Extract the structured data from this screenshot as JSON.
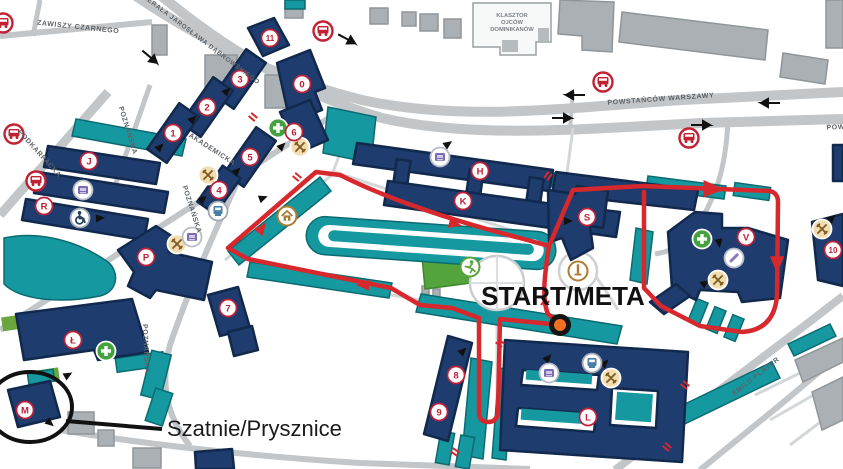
{
  "map": {
    "labels": {
      "start_meta": "START/META",
      "changing_rooms": "Szatnie/Prysznice",
      "klasztor": [
        "KLASZTOR",
        "OJCÓW",
        "DOMINIKANÓW"
      ]
    },
    "colors": {
      "navy": "#1e3c6d",
      "navy_dark": "#12294e",
      "teal": "#15989f",
      "teal_dark": "#0b6b70",
      "route_red": "#d7282d",
      "badge_red": "#c02138",
      "road_gray": "#c2c6c9",
      "building_gray": "#aab0b4",
      "field_green": "#55a33c",
      "start_orange": "#f36f21"
    },
    "streets": [
      {
        "name": "ZAWISZY CZARNEGO",
        "x": 78,
        "y": 29,
        "rot": 6,
        "size": 7
      },
      {
        "name": "GENERAŁA JAROSŁAWA DĄBROWSKIEGO",
        "x": 196,
        "y": 38,
        "rot": 37,
        "size": 6.5
      },
      {
        "name": "PODKARPACKA",
        "x": 38,
        "y": 155,
        "rot": 48,
        "size": 7
      },
      {
        "name": "POZNAŃSKA",
        "x": 126,
        "y": 131,
        "rot": 73,
        "size": 7
      },
      {
        "name": "AKADEMICKA",
        "x": 211,
        "y": 151,
        "rot": 33,
        "size": 7
      },
      {
        "name": "POZNAŃSKA",
        "x": 190,
        "y": 210,
        "rot": 72,
        "size": 7
      },
      {
        "name": "POZNAŃSKA",
        "x": 144,
        "y": 349,
        "rot": 87,
        "size": 7
      },
      {
        "name": "POWSTAŃCÓW WARSZAWY",
        "x": 661,
        "y": 101,
        "rot": -4,
        "size": 7
      },
      {
        "name": "POWSTAŃCÓW WARSZAWY",
        "x": 880,
        "y": 127,
        "rot": -3,
        "size": 7
      },
      {
        "name": "EMILII PLATER",
        "x": 757,
        "y": 378,
        "rot": -38,
        "size": 7
      }
    ],
    "badges": [
      {
        "label": "0",
        "x": 302,
        "y": 84
      },
      {
        "label": "1",
        "x": 173,
        "y": 133
      },
      {
        "label": "2",
        "x": 207,
        "y": 107
      },
      {
        "label": "3",
        "x": 240,
        "y": 79
      },
      {
        "label": "4",
        "x": 219,
        "y": 190
      },
      {
        "label": "5",
        "x": 250,
        "y": 157
      },
      {
        "label": "6",
        "x": 294,
        "y": 132
      },
      {
        "label": "7",
        "x": 228,
        "y": 308
      },
      {
        "label": "8",
        "x": 456,
        "y": 375
      },
      {
        "label": "9",
        "x": 439,
        "y": 412
      },
      {
        "label": "10",
        "x": 833,
        "y": 250
      },
      {
        "label": "11",
        "x": 270,
        "y": 38
      },
      {
        "label": "H",
        "x": 480,
        "y": 171
      },
      {
        "label": "J",
        "x": 89,
        "y": 161
      },
      {
        "label": "K",
        "x": 463,
        "y": 201
      },
      {
        "label": "L",
        "x": 588,
        "y": 417
      },
      {
        "label": "Ł",
        "x": 73,
        "y": 340
      },
      {
        "label": "M",
        "x": 25,
        "y": 410
      },
      {
        "label": "P",
        "x": 146,
        "y": 257
      },
      {
        "label": "R",
        "x": 44,
        "y": 206
      },
      {
        "label": "S",
        "x": 587,
        "y": 217
      },
      {
        "label": "V",
        "x": 746,
        "y": 237
      }
    ],
    "icons": [
      {
        "type": "bus-stop",
        "x": 3,
        "y": 23
      },
      {
        "type": "bus-stop",
        "x": 14,
        "y": 134
      },
      {
        "type": "bus-stop",
        "x": 36,
        "y": 181
      },
      {
        "type": "bus-stop",
        "x": 323,
        "y": 31
      },
      {
        "type": "bus-stop",
        "x": 603,
        "y": 82
      },
      {
        "type": "bus-stop",
        "x": 689,
        "y": 138
      },
      {
        "type": "restaurant",
        "x": 300,
        "y": 147
      },
      {
        "type": "restaurant",
        "x": 208,
        "y": 175
      },
      {
        "type": "restaurant",
        "x": 177,
        "y": 244
      },
      {
        "type": "restaurant",
        "x": 718,
        "y": 280
      },
      {
        "type": "restaurant",
        "x": 822,
        "y": 229
      },
      {
        "type": "restaurant",
        "x": 611,
        "y": 378
      },
      {
        "type": "medical",
        "x": 278,
        "y": 128
      },
      {
        "type": "medical",
        "x": 106,
        "y": 351
      },
      {
        "type": "medical",
        "x": 702,
        "y": 239
      },
      {
        "type": "printer",
        "x": 83,
        "y": 190
      },
      {
        "type": "printer",
        "x": 192,
        "y": 237
      },
      {
        "type": "printer",
        "x": 440,
        "y": 157
      },
      {
        "type": "printer",
        "x": 549,
        "y": 373
      },
      {
        "type": "atm",
        "x": 218,
        "y": 211
      },
      {
        "type": "atm",
        "x": 592,
        "y": 363
      },
      {
        "type": "wheelchair",
        "x": 80,
        "y": 218
      },
      {
        "type": "home",
        "x": 287,
        "y": 216
      },
      {
        "type": "runner",
        "x": 470,
        "y": 267
      },
      {
        "type": "monument",
        "x": 578,
        "y": 271
      },
      {
        "type": "edit",
        "x": 734,
        "y": 258
      }
    ],
    "route_arrows": [
      {
        "x": 363,
        "y": 285,
        "rot": 182,
        "s": 1
      },
      {
        "x": 262,
        "y": 228,
        "rot": -52,
        "s": 1
      },
      {
        "x": 455,
        "y": 224,
        "rot": 14,
        "s": 1
      },
      {
        "x": 713,
        "y": 189,
        "rot": 1,
        "s": 1.6
      },
      {
        "x": 777,
        "y": 264,
        "rot": 90,
        "s": 1.3
      }
    ],
    "entrance_arrows": [
      {
        "x": 193,
        "y": 119,
        "rot": -45
      },
      {
        "x": 227,
        "y": 91,
        "rot": -45
      },
      {
        "x": 160,
        "y": 147,
        "rot": -45
      },
      {
        "x": 237,
        "y": 171,
        "rot": -45
      },
      {
        "x": 282,
        "y": 146,
        "rot": -45
      },
      {
        "x": 203,
        "y": 199,
        "rot": -42
      },
      {
        "x": 263,
        "y": 198,
        "rot": -20
      },
      {
        "x": 100,
        "y": 218,
        "rot": -5
      },
      {
        "x": 568,
        "y": 221,
        "rot": 0
      },
      {
        "x": 448,
        "y": 144,
        "rot": -35
      },
      {
        "x": 463,
        "y": 351,
        "rot": -45
      },
      {
        "x": 548,
        "y": 358,
        "rot": -48
      },
      {
        "x": 605,
        "y": 363,
        "rot": -45
      },
      {
        "x": 719,
        "y": 243,
        "rot": 80
      },
      {
        "x": 705,
        "y": 283,
        "rot": -35
      },
      {
        "x": 832,
        "y": 218,
        "rot": -45
      },
      {
        "x": 68,
        "y": 375,
        "rot": -30
      },
      {
        "x": 50,
        "y": 423,
        "rot": 40
      }
    ],
    "traffic_arrows": [
      {
        "x": 575,
        "y": 95,
        "rot": 180
      },
      {
        "x": 770,
        "y": 103,
        "rot": 180
      },
      {
        "x": 562,
        "y": 118,
        "rot": 0
      },
      {
        "x": 701,
        "y": 125,
        "rot": 0
      },
      {
        "x": 150,
        "y": 57,
        "rot": 40
      },
      {
        "x": 347,
        "y": 39,
        "rot": 28
      }
    ],
    "gate_markers": [
      {
        "x": 253,
        "y": 117,
        "rot": 40
      },
      {
        "x": 297,
        "y": 177,
        "rot": 40
      },
      {
        "x": 548,
        "y": 176,
        "rot": -55
      },
      {
        "x": 545,
        "y": 303,
        "rot": -55
      },
      {
        "x": 500,
        "y": 343,
        "rot": 35
      },
      {
        "x": 455,
        "y": 452,
        "rot": 35
      },
      {
        "x": 685,
        "y": 385,
        "rot": 40
      },
      {
        "x": 667,
        "y": 447,
        "rot": 40
      }
    ],
    "start_point": {
      "x": 560,
      "y": 325
    }
  }
}
